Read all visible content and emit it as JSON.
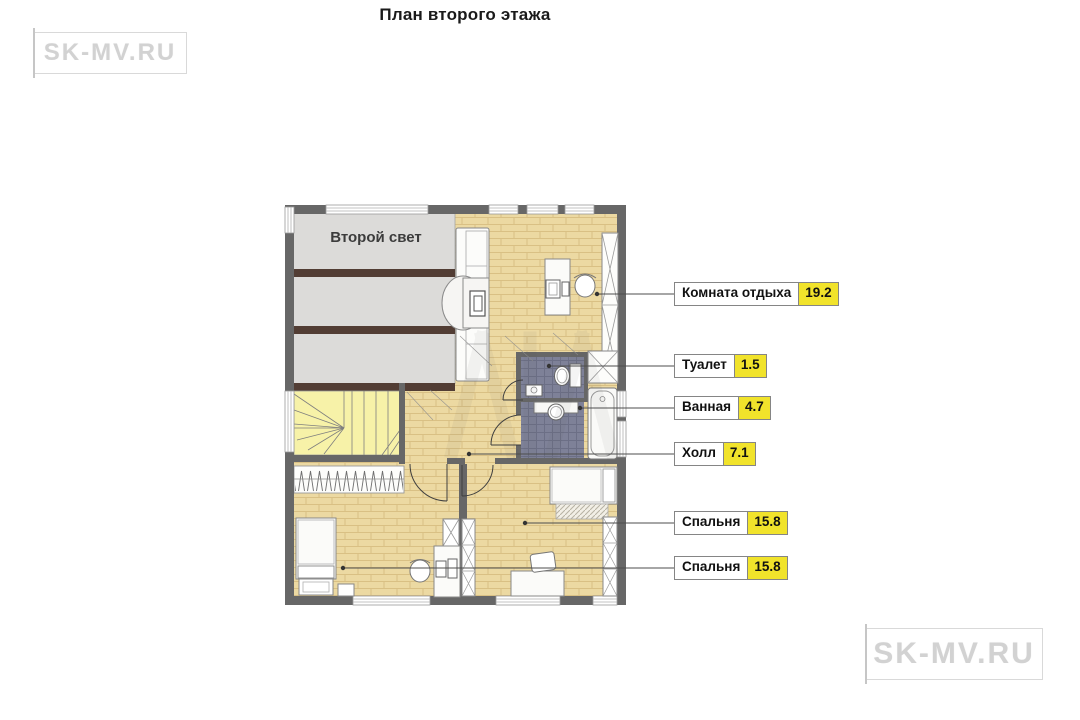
{
  "title": "План второго этажа",
  "logo_top_left": "SK-MV.RU",
  "logo_bottom_right": "SK-MV.RU",
  "plan": {
    "second_light_label": "Второй свет",
    "labels": [
      {
        "name": "Комната отдыха",
        "area": "19.2"
      },
      {
        "name": "Туалет",
        "area": "1.5"
      },
      {
        "name": "Ванная",
        "area": "4.7"
      },
      {
        "name": "Холл",
        "area": "7.1"
      },
      {
        "name": "Спальня",
        "area": "15.8"
      },
      {
        "name": "Спальня",
        "area": "15.8"
      }
    ],
    "colors": {
      "wall": "#676767",
      "wood_floor": "#ecd9a2",
      "second_light_bg": "#dcdbd9",
      "beam": "#523d34",
      "stair": "#f7f2a8",
      "tile": "#7e8198",
      "area_badge": "#f1e32b"
    }
  }
}
